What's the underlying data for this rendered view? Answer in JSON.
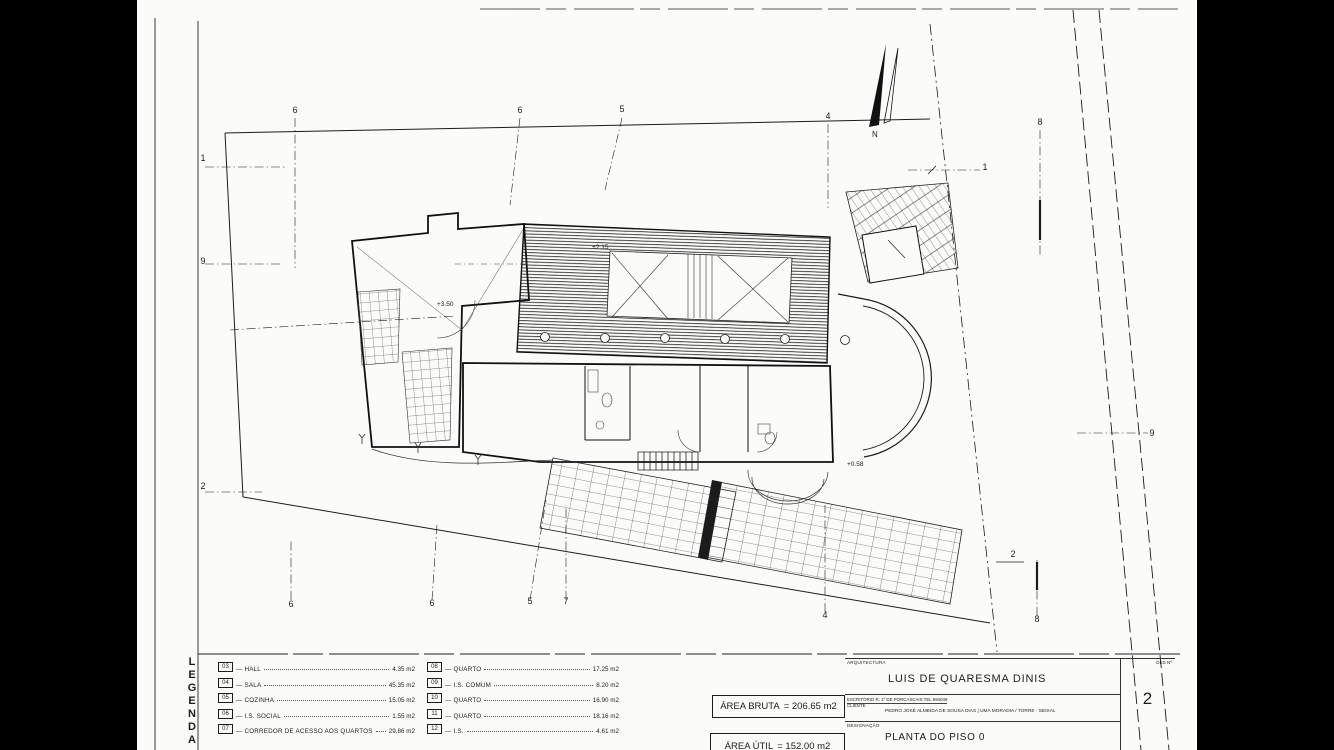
{
  "page": {
    "bg": "#000000",
    "paper": "#fbfbf9",
    "ink": "#1c1c1c"
  },
  "plan": {
    "north_label": "N",
    "grid_markers": {
      "top": [
        "6",
        "6",
        "5",
        "4",
        "8"
      ],
      "bottom": [
        "6",
        "6",
        "5",
        "7",
        "4",
        "8"
      ],
      "left": [
        "1",
        "9",
        "2"
      ],
      "right": [
        "1",
        "9",
        "2"
      ]
    },
    "annotations": [
      "+2.15",
      "+3.50",
      "+0.58"
    ]
  },
  "legend": {
    "title_letters": [
      "L",
      "E",
      "G",
      "E",
      "N",
      "D",
      "A"
    ],
    "left_column": [
      {
        "num": "03",
        "label": "HALL",
        "area": "4.35 m2"
      },
      {
        "num": "04",
        "label": "SALA",
        "area": "45.35 m2"
      },
      {
        "num": "05",
        "label": "COZINHA",
        "area": "15.05 m2"
      },
      {
        "num": "06",
        "label": "I.S. SOCIAL",
        "area": "1.55 m2"
      },
      {
        "num": "07",
        "label": "CORREDOR DE ACESSO AOS QUARTOS",
        "area": "29.86 m2"
      }
    ],
    "right_column": [
      {
        "num": "08",
        "label": "QUARTO",
        "area": "17.25 m2"
      },
      {
        "num": "09",
        "label": "I.S. COMUM",
        "area": "8.20 m2"
      },
      {
        "num": "10",
        "label": "QUARTO",
        "area": "16.90 m2"
      },
      {
        "num": "11",
        "label": "QUARTO",
        "area": "18.16 m2"
      },
      {
        "num": "12",
        "label": "I.S.",
        "area": "4.61 m2"
      }
    ]
  },
  "areas": {
    "bruta_label": "ÁREA BRUTA",
    "bruta_value": "= 206.65 m2",
    "util_label": "ÁREA ÚTIL",
    "util_value": "= 152.00 m2"
  },
  "title_block": {
    "architecture_label": "ARQUITECTURA",
    "architect_name": "LUIS DE QUARESMA DINIS",
    "office_line": "ESCRITÓRIO  R. 1º DE PORCASCAIS  TEL 594049",
    "client_label": "CLIENTE",
    "client_line": "PEDRO JOSÉ ALMEIDA DE SOUSA DIAS | UMA MORADIA / TORRE - SEIXAL",
    "designation_label": "DESIGNAÇÃO",
    "designation": "PLANTA DO PISO 0",
    "sheet_label": "DES Nº",
    "sheet_number": "2"
  }
}
